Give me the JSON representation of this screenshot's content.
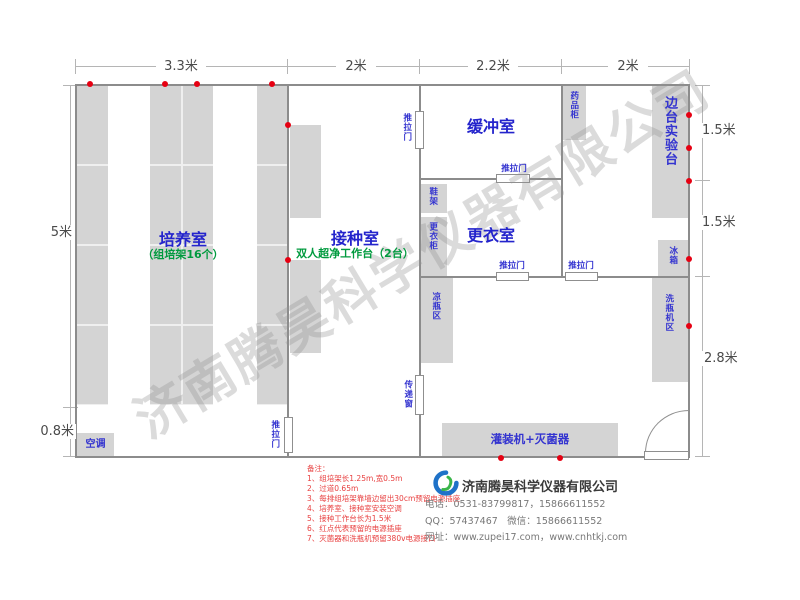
{
  "watermark": "济南腾昊科学仪器有限公司",
  "dimensions": {
    "top": [
      "3.3米",
      "2米",
      "2.2米",
      "2米"
    ],
    "left_height": "5米",
    "left_bottom": "0.8米",
    "right_top": "1.5米",
    "right_mid": "1.5米",
    "right_bottom": "2.8米"
  },
  "rooms": {
    "culture": {
      "name": "培养室",
      "sub": "（组培架16个）"
    },
    "inoculation": {
      "name": "接种室",
      "sub": "双人超净工作台（2台）"
    },
    "buffer": {
      "name": "缓冲室"
    },
    "changing": {
      "name": "更衣室"
    }
  },
  "labels": {
    "air_conditioner": "空调",
    "sliding_door": "推拉门",
    "shoe_rack": "鞋架",
    "wardrobe": "更衣柜",
    "medicine_cabinet": "药品柜",
    "cool_bottle_area": "凉瓶区",
    "transfer_window": "传递窗",
    "side_bench": "边台实验台",
    "fridge": "冰箱",
    "bottle_washer_area": "洗瓶机区",
    "filling_sterilizer": "灌装机+灭菌器"
  },
  "notes": {
    "title": "备注：",
    "items": [
      "1、组培架长1.25m,宽0.5m",
      "2、过道0.65m",
      "3、每排组培架靠墙边留出30cm预留电源插座",
      "4、培养室、接种室安装空调",
      "5、接种工作台长为1.5米",
      "6、红点代表预留的电源插座",
      "7、灭菌器和洗瓶机预留380v电源接口"
    ]
  },
  "footer": {
    "company": "济南腾昊科学仪器有限公司",
    "phone": "电话：0531-83799817，15866611552",
    "qq": "QQ：57437467　微信：15866611552",
    "website": "网址：www.zupei17.com，www.cnhtkj.com"
  },
  "colors": {
    "room_label": "#2424cc",
    "sub_label": "#009a3e",
    "wall": "#8c8c8c",
    "furniture": "#d4d4d4",
    "socket_dot": "#e60012",
    "note_red": "#e84040"
  }
}
